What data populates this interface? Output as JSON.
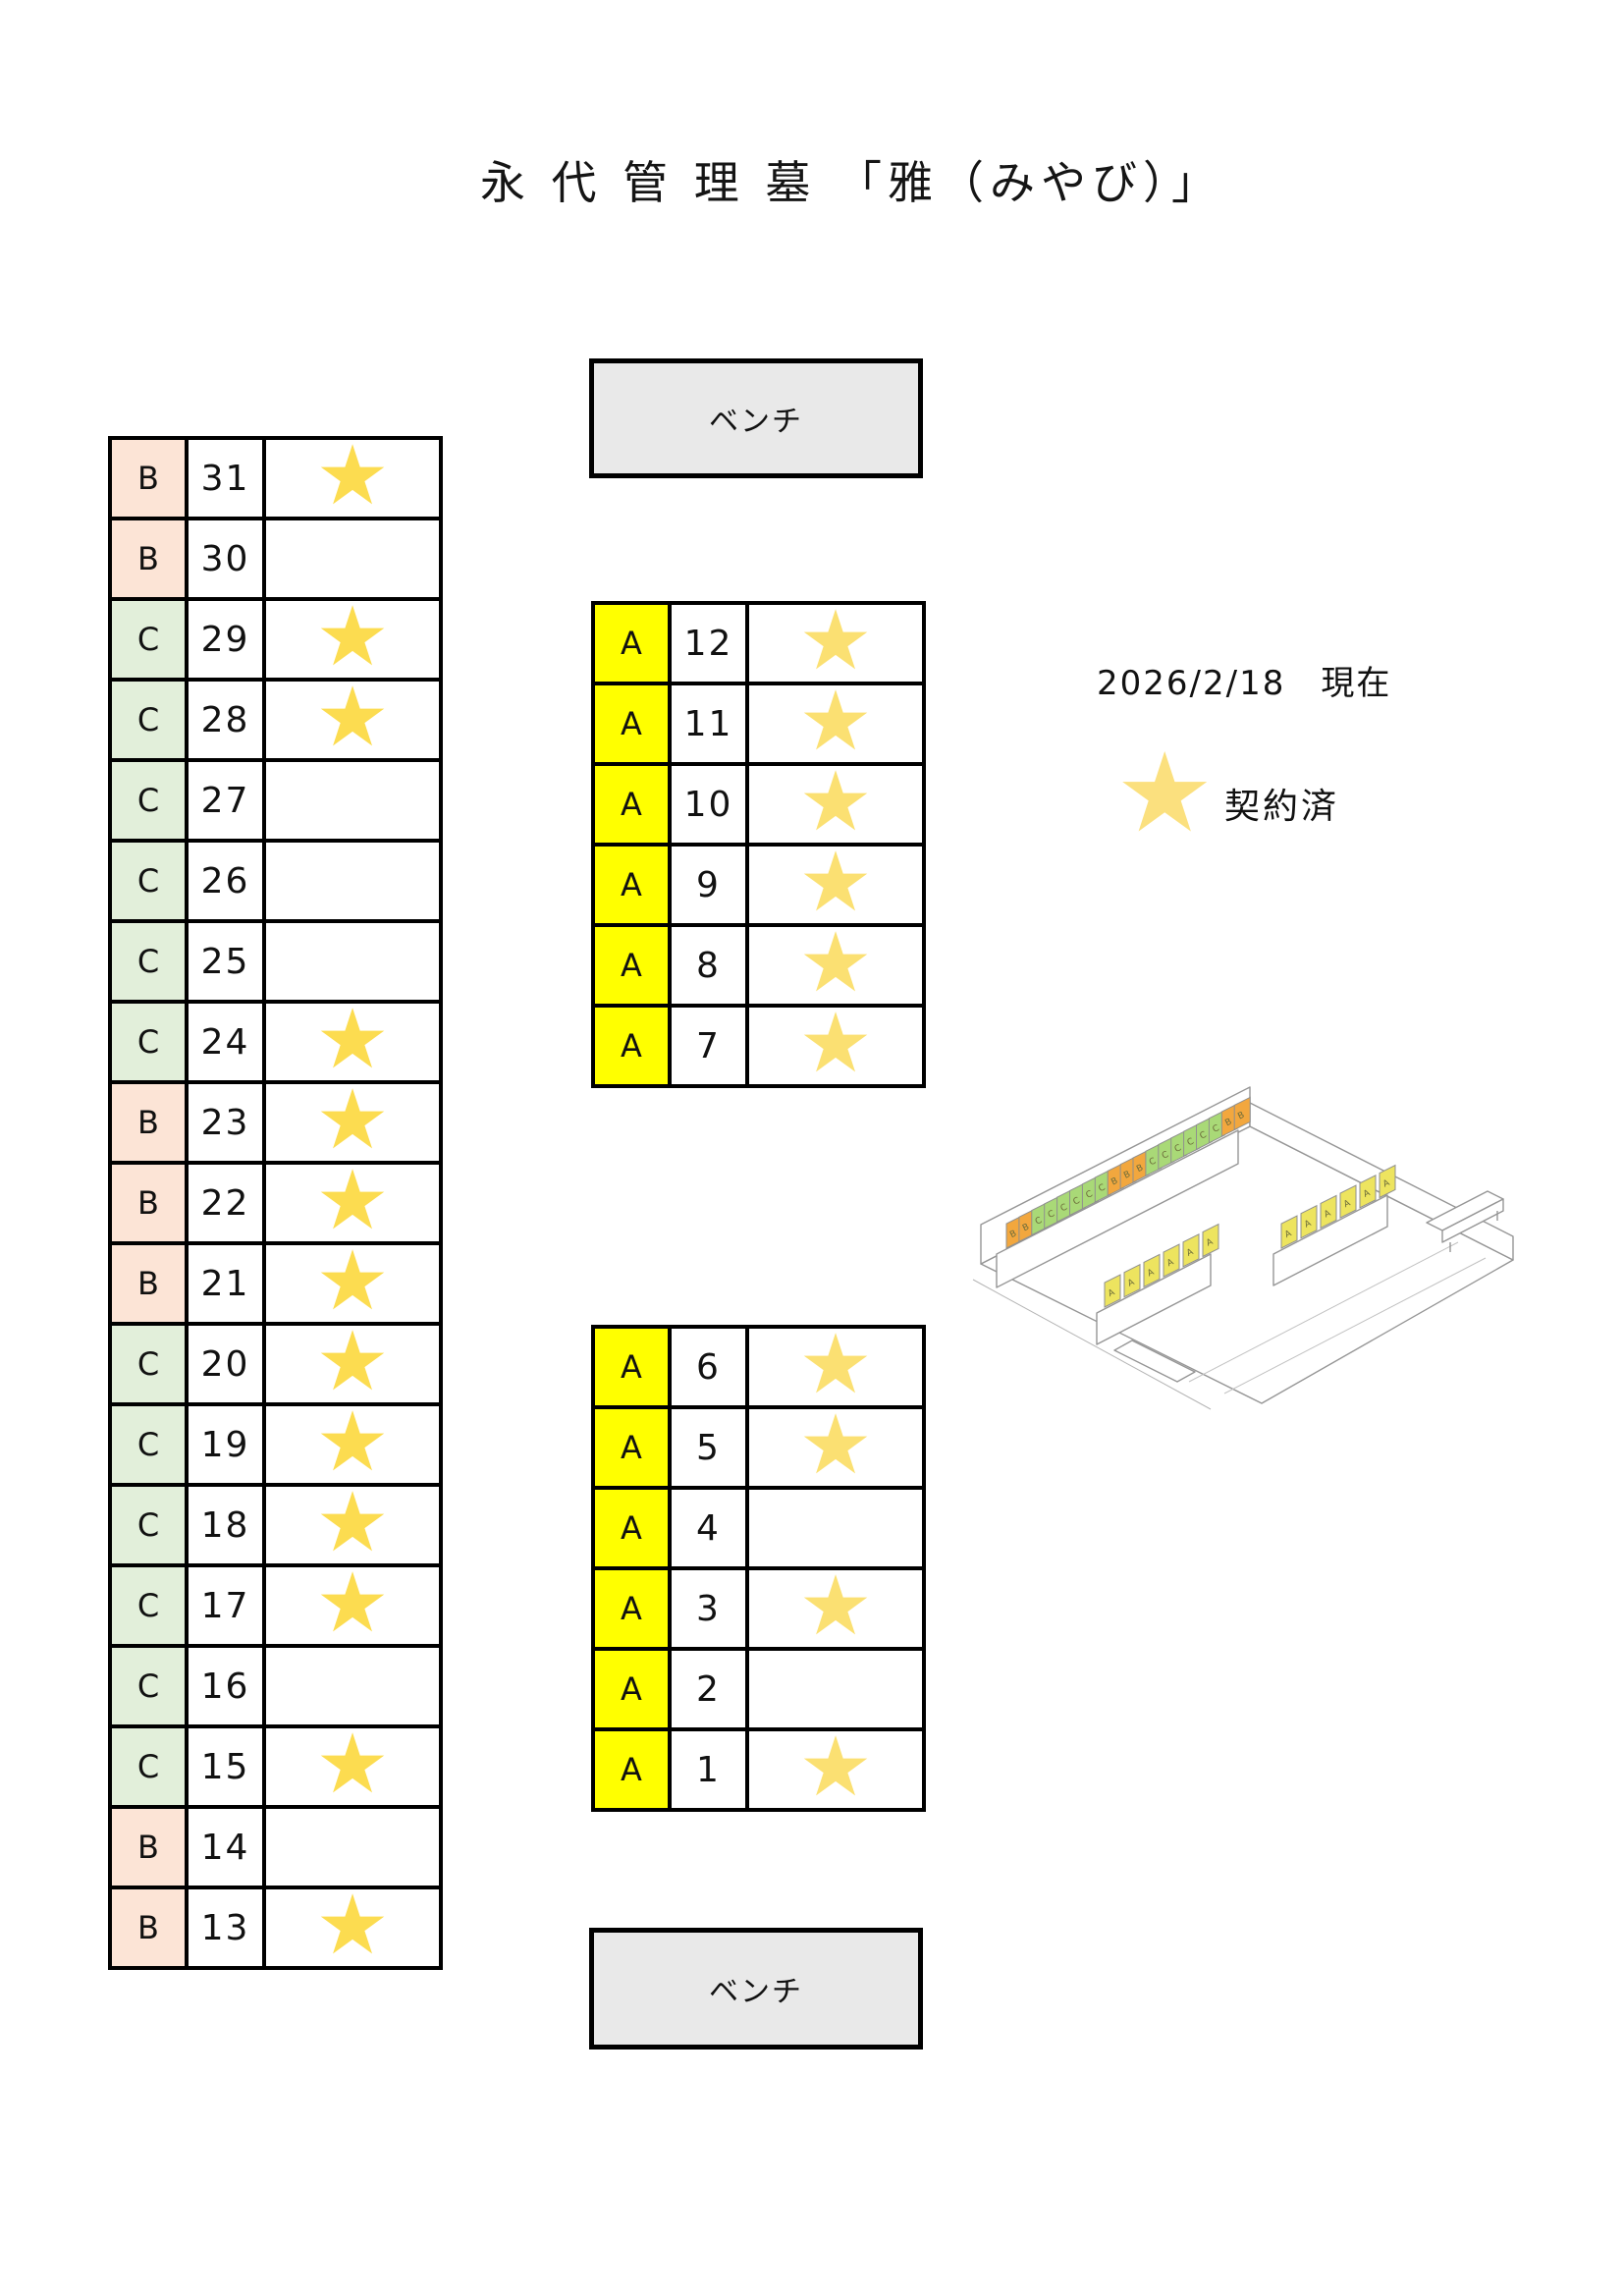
{
  "title": "永 代 管 理 墓 「雅（みやび）」",
  "benches": {
    "top": "ベンチ",
    "bottom": "ベンチ"
  },
  "legend": {
    "date": "2026/2/18　現在",
    "star_label": "契約済"
  },
  "icons": {
    "star": "★"
  },
  "colors": {
    "block_a_bg": "#FFFF00",
    "block_b_bg": "#FCE4D6",
    "block_c_bg": "#E2EFDA",
    "star_gold": "#FCDC50",
    "star_light": "#FBE072",
    "bench_bg": "#E9E9E9"
  },
  "left_table": {
    "rows": [
      {
        "block": "B",
        "number": "31",
        "reserved": true
      },
      {
        "block": "B",
        "number": "30",
        "reserved": false
      },
      {
        "block": "C",
        "number": "29",
        "reserved": true
      },
      {
        "block": "C",
        "number": "28",
        "reserved": true
      },
      {
        "block": "C",
        "number": "27",
        "reserved": false
      },
      {
        "block": "C",
        "number": "26",
        "reserved": false
      },
      {
        "block": "C",
        "number": "25",
        "reserved": false
      },
      {
        "block": "C",
        "number": "24",
        "reserved": true
      },
      {
        "block": "B",
        "number": "23",
        "reserved": true
      },
      {
        "block": "B",
        "number": "22",
        "reserved": true
      },
      {
        "block": "B",
        "number": "21",
        "reserved": true
      },
      {
        "block": "C",
        "number": "20",
        "reserved": true
      },
      {
        "block": "C",
        "number": "19",
        "reserved": true
      },
      {
        "block": "C",
        "number": "18",
        "reserved": true
      },
      {
        "block": "C",
        "number": "17",
        "reserved": true
      },
      {
        "block": "C",
        "number": "16",
        "reserved": false
      },
      {
        "block": "C",
        "number": "15",
        "reserved": true
      },
      {
        "block": "B",
        "number": "14",
        "reserved": false
      },
      {
        "block": "B",
        "number": "13",
        "reserved": true
      }
    ]
  },
  "mid_top_table": {
    "rows": [
      {
        "block": "A",
        "number": "12",
        "reserved": true
      },
      {
        "block": "A",
        "number": "11",
        "reserved": true
      },
      {
        "block": "A",
        "number": "10",
        "reserved": true
      },
      {
        "block": "A",
        "number": "9",
        "reserved": true
      },
      {
        "block": "A",
        "number": "8",
        "reserved": true
      },
      {
        "block": "A",
        "number": "7",
        "reserved": true
      }
    ]
  },
  "mid_bottom_table": {
    "rows": [
      {
        "block": "A",
        "number": "6",
        "reserved": true
      },
      {
        "block": "A",
        "number": "5",
        "reserved": true
      },
      {
        "block": "A",
        "number": "4",
        "reserved": false
      },
      {
        "block": "A",
        "number": "3",
        "reserved": true
      },
      {
        "block": "A",
        "number": "2",
        "reserved": false
      },
      {
        "block": "A",
        "number": "1",
        "reserved": true
      }
    ]
  },
  "illustration": {
    "back_row_blocks": [
      "B",
      "B",
      "C",
      "C",
      "C",
      "C",
      "C",
      "C",
      "B",
      "B",
      "B",
      "C",
      "C",
      "C",
      "C",
      "C",
      "C",
      "B",
      "B"
    ],
    "front_left_blocks": [
      "A",
      "A",
      "A",
      "A",
      "A",
      "A"
    ],
    "front_right_blocks": [
      "A",
      "A",
      "A",
      "A",
      "A",
      "A"
    ],
    "plate_colors": {
      "A": "#EDE45F",
      "B": "#F2A73E",
      "C": "#A9D977"
    }
  }
}
